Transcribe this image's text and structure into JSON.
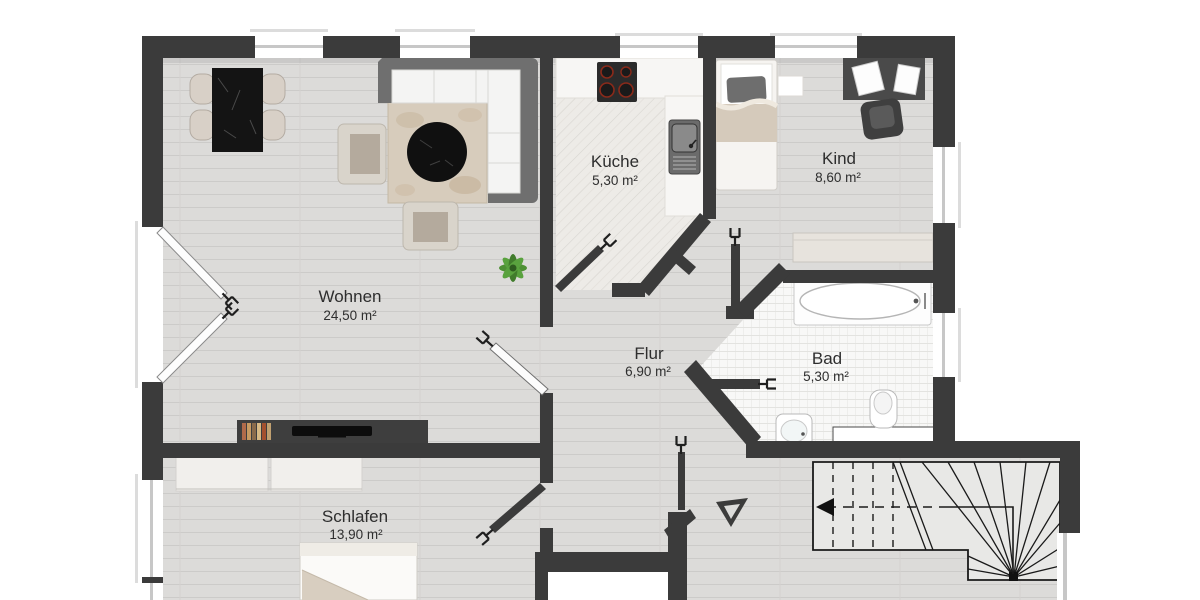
{
  "plan": {
    "type": "apartment-floor-plan",
    "rooms": {
      "wohnen": {
        "name": "Wohnen",
        "area": "24,50 m²"
      },
      "kueche": {
        "name": "Küche",
        "area": "5,30 m²"
      },
      "kind": {
        "name": "Kind",
        "area": "8,60 m²"
      },
      "bad": {
        "name": "Bad",
        "area": "5,30 m²"
      },
      "flur": {
        "name": "Flur",
        "area": "6,90 m²"
      },
      "schlafen": {
        "name": "Schlafen",
        "area": "13,90 m²"
      }
    },
    "colors": {
      "wall": "#3b3b3b",
      "label_text": "#2e2e2e",
      "floor_wood": "#dcdbd9",
      "floor_tile_kitchen": "#edebe7",
      "floor_tile_bath": "#f8f8f7",
      "stair_fill": "#e8e8e6",
      "sofa": "#6f6f6f",
      "furniture_beige": "#d8d0c5",
      "plant_green": "#4e9035"
    }
  }
}
